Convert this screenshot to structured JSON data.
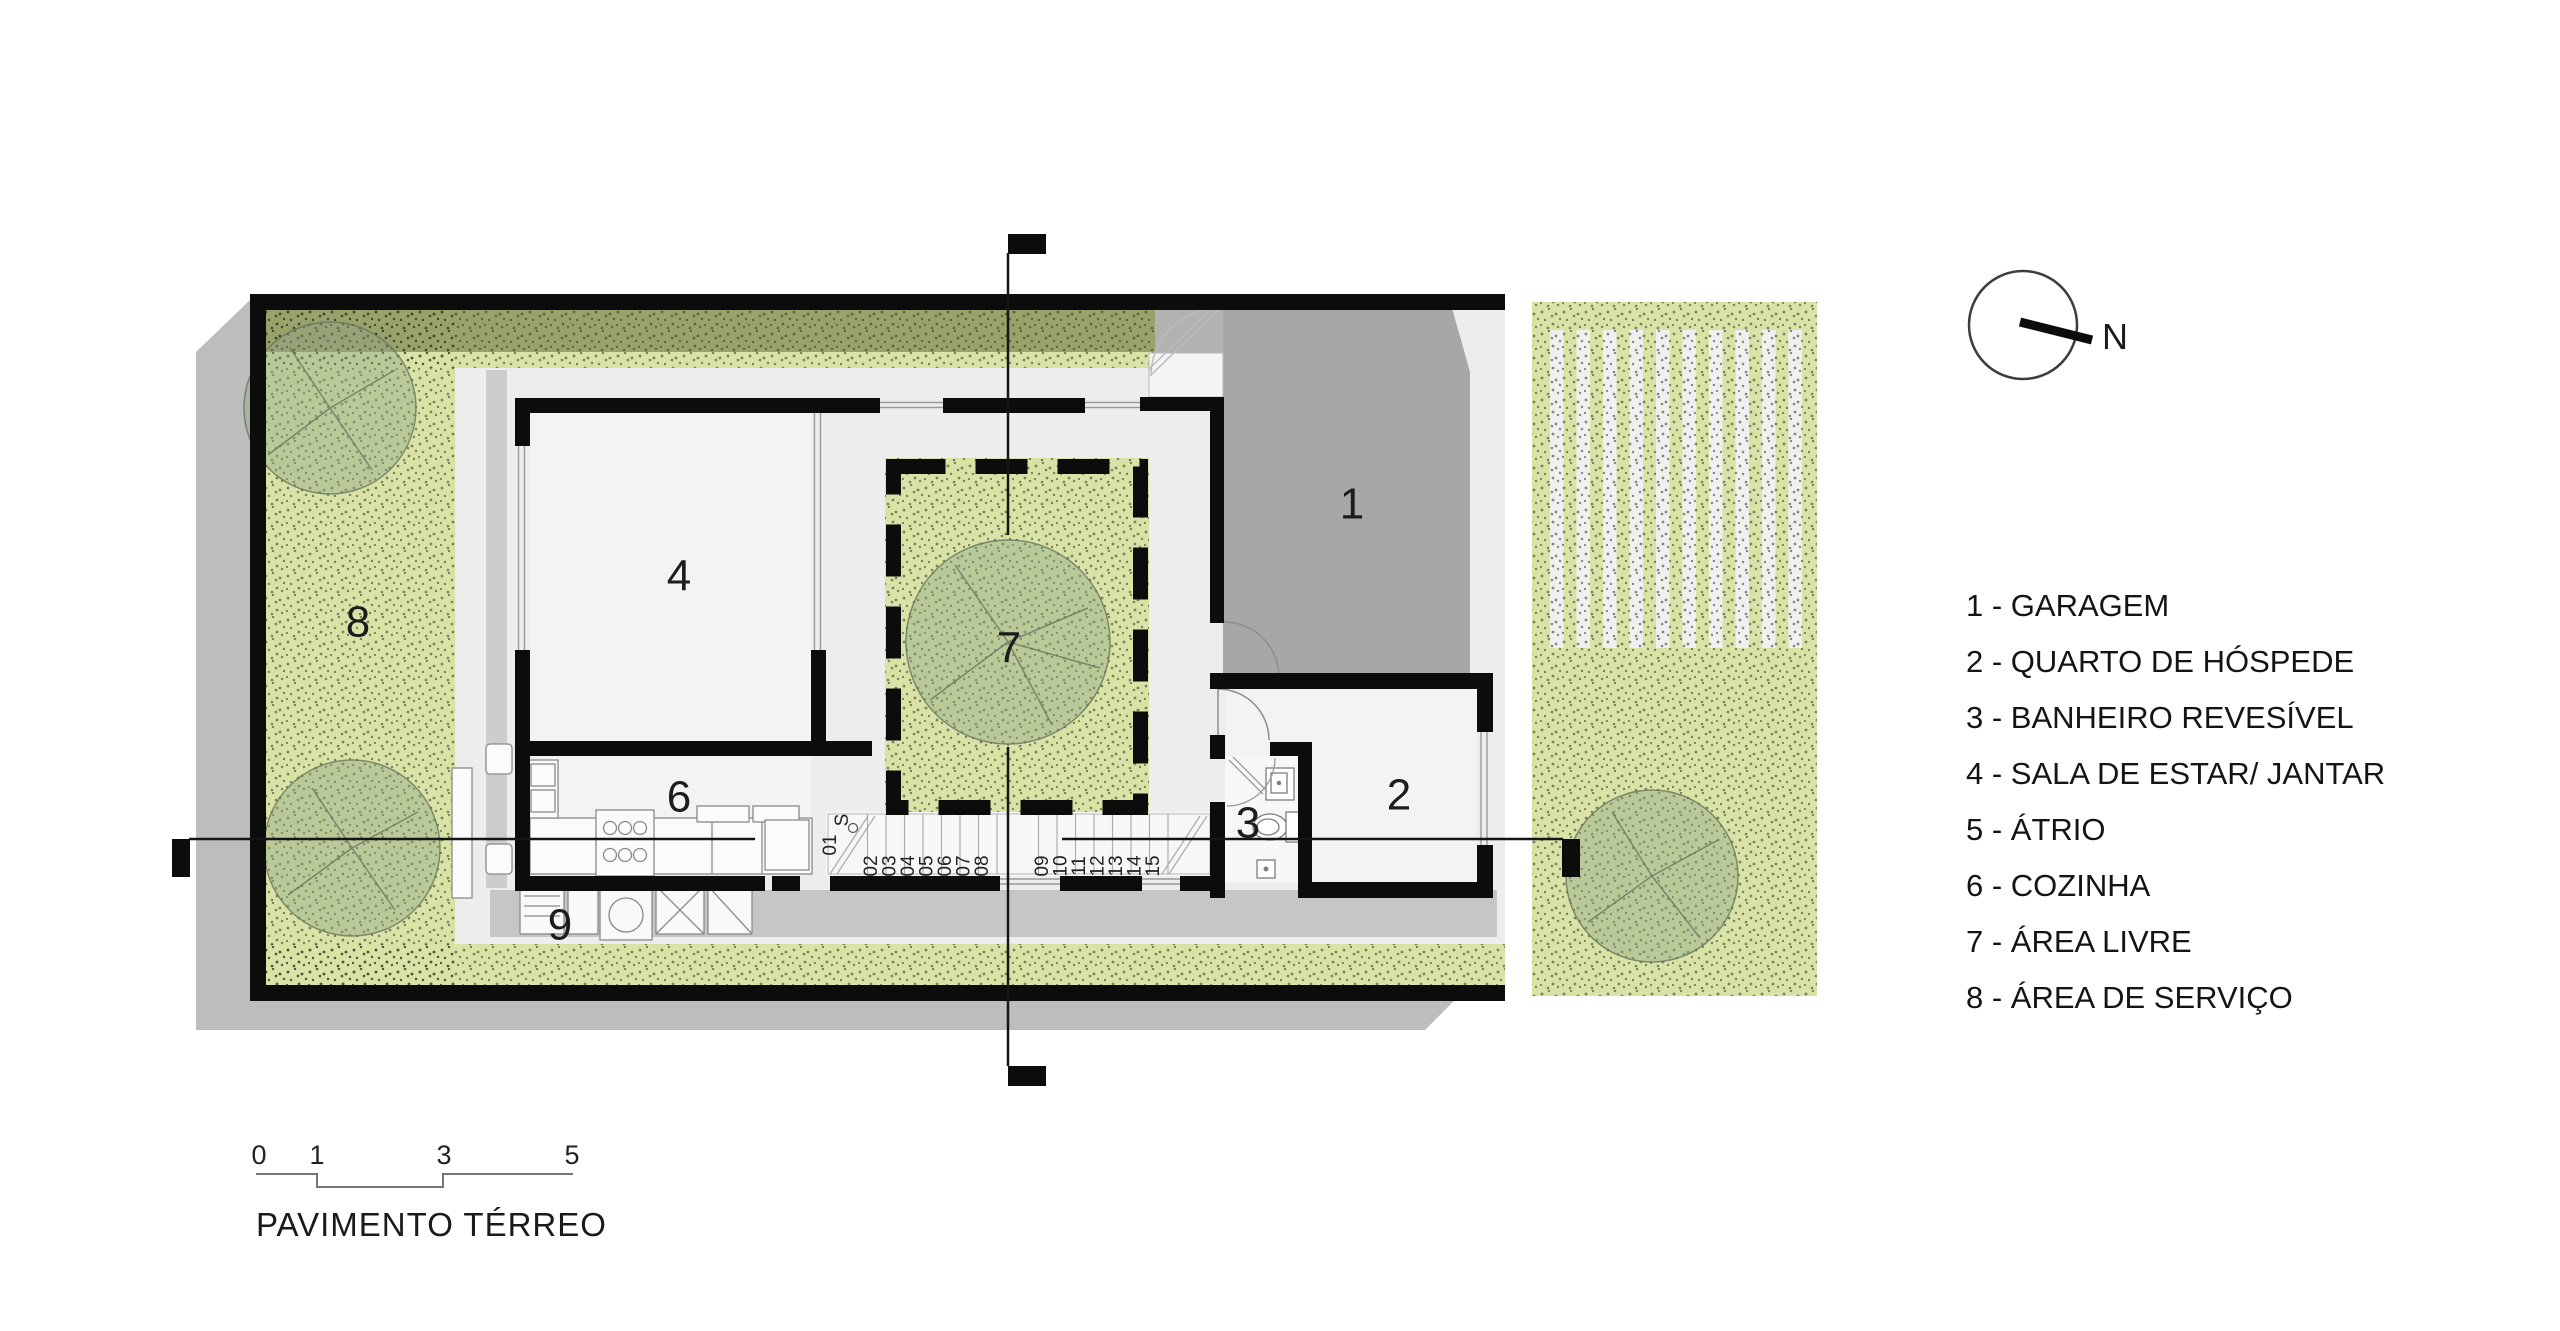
{
  "title": "PAVIMENTO TÉRREO",
  "compass": {
    "label": "N"
  },
  "legend": {
    "items": [
      "1 - GARAGEM",
      "2 - QUARTO DE HÓSPEDE",
      "3 - BANHEIRO REVESÍVEL",
      "4 - SALA DE ESTAR/ JANTAR",
      "5 - ÁTRIO",
      "6 - COZINHA",
      "7 - ÁREA LIVRE",
      "8 - ÁREA DE SERVIÇO"
    ]
  },
  "scale_bar": {
    "ticks": [
      "0",
      "1",
      "3",
      "5"
    ]
  },
  "plan": {
    "room_labels": {
      "garage": "1",
      "guest_room": "2",
      "bathroom": "3",
      "living_dining": "4",
      "kitchen": "6",
      "courtyard": "7",
      "service_area": "8",
      "laundry": "9"
    },
    "stairs": {
      "start_label": "S",
      "first_step": "01",
      "treads_run1": [
        "02",
        "03",
        "04",
        "05",
        "06",
        "07",
        "08"
      ],
      "treads_run2": [
        "09",
        "10",
        "11",
        "12",
        "13",
        "14",
        "15"
      ]
    }
  },
  "colors": {
    "garden_green": "#d9e3a6",
    "hedge_olive": "#99a26b",
    "garage_gray": "#a7a7a7",
    "shadow_gray": "#bdbdbd",
    "wall_black": "#0c0c0c"
  }
}
